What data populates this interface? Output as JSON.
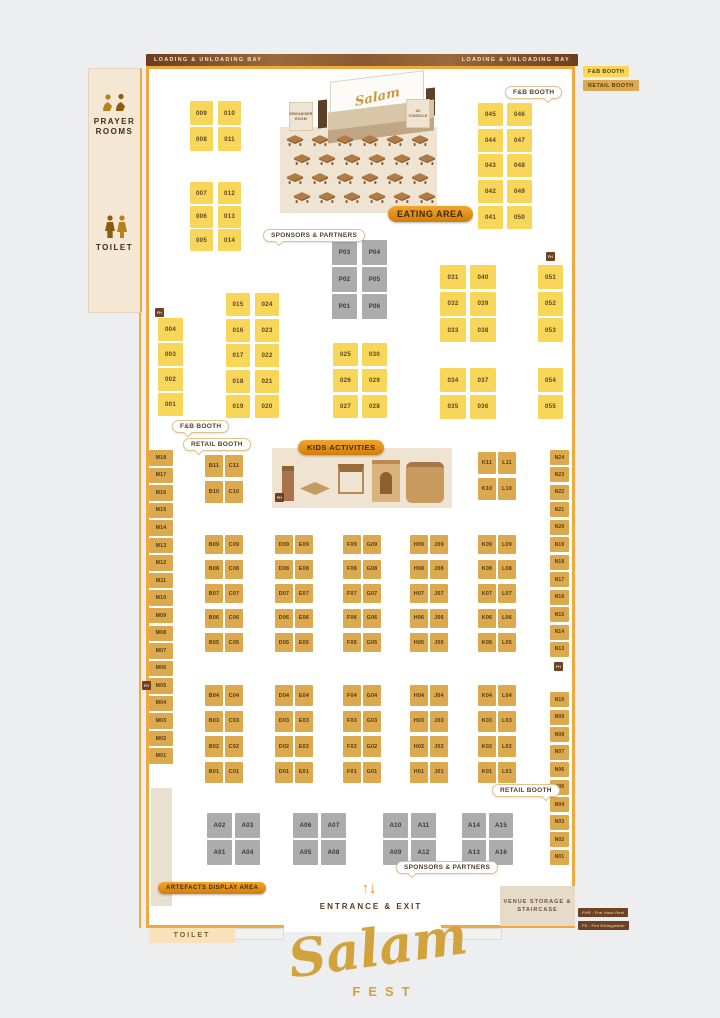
{
  "loading_bay_label": "LOADING & UNLOADING BAY",
  "legend": {
    "fnb_label": "F&B BOOTH",
    "retail_label": "RETAIL BOOTH"
  },
  "sidebar": {
    "prayer_label": "PRAYER ROOMS",
    "toilet_label": "TOILET"
  },
  "stage": {
    "organiser_label": "ORGANISER ROOM",
    "av_label": "AV CONSOLE",
    "screen_text": "Salam"
  },
  "badges": {
    "eating": "EATING AREA",
    "kids": "KIDS ACTIVITIES",
    "artefacts": "ARTEFACTS DISPLAY AREA"
  },
  "bubbles": {
    "fnb_top": "F&B BOOTH",
    "fnb_left": "F&B BOOTH",
    "retail_mid": "RETAIL BOOTH",
    "retail_bottom": "RETAIL BOOTH",
    "sponsors_top": "SPONSORS & PARTNERS",
    "sponsors_bottom": "SPONSORS & PARTNERS"
  },
  "bottom": {
    "entrance": "ENTRANCE & EXIT",
    "venue_storage": "VENUE STORAGE & STAIRCASE",
    "toilet": "TOILET",
    "logo_script": "Salam",
    "logo_sub": "FEST"
  },
  "fire_legend": {
    "marker": "FH",
    "fhr": "FHR : Fire Hose Reel",
    "fe": "FE : Fire Extinguisher"
  },
  "colors": {
    "fnb": "#F8D65A",
    "retail": "#DCA94E",
    "sponsor": "#ACACAC",
    "accent_orange": "#EFA93F",
    "brown": "#6F4123",
    "beige": "#EFE3D2",
    "gold_logo": "#D2A23C"
  },
  "booth_groups": [
    {
      "id": "tlA",
      "type": "fnb",
      "rows": [
        [
          "009",
          "010"
        ],
        [
          "008",
          "011"
        ]
      ]
    },
    {
      "id": "tlB",
      "type": "fnb",
      "rows": [
        [
          "007",
          "012"
        ],
        [
          "006",
          "013"
        ],
        [
          "005",
          "014"
        ]
      ]
    },
    {
      "id": "tr",
      "type": "fnb",
      "rows": [
        [
          "045",
          "046"
        ],
        [
          "044",
          "047"
        ],
        [
          "043",
          "048"
        ],
        [
          "042",
          "049"
        ],
        [
          "041",
          "050"
        ]
      ]
    },
    {
      "id": "p",
      "type": "sponsor",
      "rows": [
        [
          "P03",
          "P04"
        ],
        [
          "P02",
          "P05"
        ],
        [
          "P01",
          "P06"
        ]
      ]
    },
    {
      "id": "c001",
      "type": "fnb",
      "rows": [
        [
          "004"
        ],
        [
          "003"
        ],
        [
          "002"
        ],
        [
          "001"
        ]
      ]
    },
    {
      "id": "g015",
      "type": "fnb",
      "rows": [
        [
          "015",
          "024"
        ],
        [
          "016",
          "023"
        ],
        [
          "017",
          "022"
        ],
        [
          "018",
          "021"
        ],
        [
          "019",
          "020"
        ]
      ]
    },
    {
      "id": "g025",
      "type": "fnb",
      "rows": [
        [
          "025",
          "030"
        ],
        [
          "026",
          "029"
        ],
        [
          "027",
          "028"
        ]
      ]
    },
    {
      "id": "g031",
      "type": "fnb",
      "rows": [
        [
          "031",
          "040"
        ],
        [
          "032",
          "039"
        ],
        [
          "033",
          "038"
        ]
      ]
    },
    {
      "id": "g034",
      "type": "fnb",
      "rows": [
        [
          "034",
          "037"
        ],
        [
          "035",
          "036"
        ]
      ]
    },
    {
      "id": "g051",
      "type": "fnb",
      "rows": [
        [
          "051"
        ],
        [
          "052"
        ],
        [
          "053"
        ]
      ]
    },
    {
      "id": "g054",
      "type": "fnb",
      "rows": [
        [
          "054"
        ],
        [
          "055"
        ]
      ]
    },
    {
      "id": "bc11",
      "type": "retail",
      "rows": [
        [
          "B11",
          "C11"
        ],
        [
          "B10",
          "C10"
        ]
      ]
    },
    {
      "id": "kl11",
      "type": "retail",
      "rows": [
        [
          "K11",
          "L11"
        ],
        [
          "K10",
          "L10"
        ]
      ]
    },
    {
      "id": "mCol",
      "type": "retail",
      "rows": [
        [
          "M18"
        ],
        [
          "M17"
        ],
        [
          "M16"
        ],
        [
          "M15"
        ],
        [
          "M14"
        ],
        [
          "M13"
        ],
        [
          "M12"
        ],
        [
          "M11"
        ],
        [
          "M10"
        ],
        [
          "M09"
        ],
        [
          "M08"
        ],
        [
          "M07"
        ],
        [
          "M06"
        ],
        [
          "M05"
        ],
        [
          "M04"
        ],
        [
          "M03"
        ],
        [
          "M02"
        ],
        [
          "M01"
        ]
      ]
    },
    {
      "id": "nUp",
      "type": "retail",
      "rows": [
        [
          "N24"
        ],
        [
          "N23"
        ],
        [
          "N22"
        ],
        [
          "N21"
        ],
        [
          "N20"
        ],
        [
          "N19"
        ],
        [
          "N18"
        ],
        [
          "N17"
        ],
        [
          "N16"
        ],
        [
          "N15"
        ],
        [
          "N14"
        ],
        [
          "N13"
        ]
      ]
    },
    {
      "id": "nLow",
      "type": "retail",
      "rows": [
        [
          "N10"
        ],
        [
          "N09"
        ],
        [
          "N08"
        ],
        [
          "N07"
        ],
        [
          "N06"
        ],
        [
          "N05"
        ],
        [
          "N04"
        ],
        [
          "N03"
        ],
        [
          "N02"
        ],
        [
          "N01"
        ]
      ]
    },
    {
      "id": "gtBC",
      "type": "retail",
      "rows": [
        [
          "B09",
          "C09"
        ],
        [
          "B08",
          "C08"
        ],
        [
          "B07",
          "C07"
        ],
        [
          "B06",
          "C06"
        ],
        [
          "B05",
          "C05"
        ]
      ]
    },
    {
      "id": "gtDE",
      "type": "retail",
      "rows": [
        [
          "D09",
          "E09"
        ],
        [
          "D08",
          "E08"
        ],
        [
          "D07",
          "E07"
        ],
        [
          "D06",
          "E06"
        ],
        [
          "D05",
          "E05"
        ]
      ]
    },
    {
      "id": "gtFG",
      "type": "retail",
      "rows": [
        [
          "F09",
          "G09"
        ],
        [
          "F08",
          "G08"
        ],
        [
          "F07",
          "G07"
        ],
        [
          "F06",
          "G06"
        ],
        [
          "F05",
          "G05"
        ]
      ]
    },
    {
      "id": "gtHJ",
      "type": "retail",
      "rows": [
        [
          "H09",
          "J09"
        ],
        [
          "H08",
          "J08"
        ],
        [
          "H07",
          "J07"
        ],
        [
          "H06",
          "J06"
        ],
        [
          "H05",
          "J05"
        ]
      ]
    },
    {
      "id": "gtKL",
      "type": "retail",
      "rows": [
        [
          "K09",
          "L09"
        ],
        [
          "K08",
          "L08"
        ],
        [
          "K07",
          "L07"
        ],
        [
          "K06",
          "L06"
        ],
        [
          "K05",
          "L05"
        ]
      ]
    },
    {
      "id": "gbBC",
      "type": "retail",
      "rows": [
        [
          "B04",
          "C04"
        ],
        [
          "B03",
          "C03"
        ],
        [
          "B02",
          "C02"
        ],
        [
          "B01",
          "C01"
        ]
      ]
    },
    {
      "id": "gbDE",
      "type": "retail",
      "rows": [
        [
          "D04",
          "E04"
        ],
        [
          "D03",
          "E03"
        ],
        [
          "D02",
          "E02"
        ],
        [
          "D01",
          "E01"
        ]
      ]
    },
    {
      "id": "gbFG",
      "type": "retail",
      "rows": [
        [
          "F04",
          "G04"
        ],
        [
          "F03",
          "G03"
        ],
        [
          "F02",
          "G02"
        ],
        [
          "F01",
          "G01"
        ]
      ]
    },
    {
      "id": "gbHJ",
      "type": "retail",
      "rows": [
        [
          "H04",
          "J04"
        ],
        [
          "H03",
          "J03"
        ],
        [
          "H02",
          "J02"
        ],
        [
          "H01",
          "J01"
        ]
      ]
    },
    {
      "id": "gbKL",
      "type": "retail",
      "rows": [
        [
          "K04",
          "L04"
        ],
        [
          "K03",
          "L03"
        ],
        [
          "K02",
          "L02"
        ],
        [
          "K01",
          "L01"
        ]
      ]
    },
    {
      "id": "a1",
      "type": "sponsor",
      "rows": [
        [
          "A02",
          "A03"
        ],
        [
          "A01",
          "A04"
        ]
      ]
    },
    {
      "id": "a2",
      "type": "sponsor",
      "rows": [
        [
          "A06",
          "A07"
        ],
        [
          "A05",
          "A08"
        ]
      ]
    },
    {
      "id": "a3",
      "type": "sponsor",
      "rows": [
        [
          "A10",
          "A11"
        ],
        [
          "A09",
          "A12"
        ]
      ]
    },
    {
      "id": "a4",
      "type": "sponsor",
      "rows": [
        [
          "A14",
          "A15"
        ],
        [
          "A13",
          "A16"
        ]
      ]
    }
  ]
}
